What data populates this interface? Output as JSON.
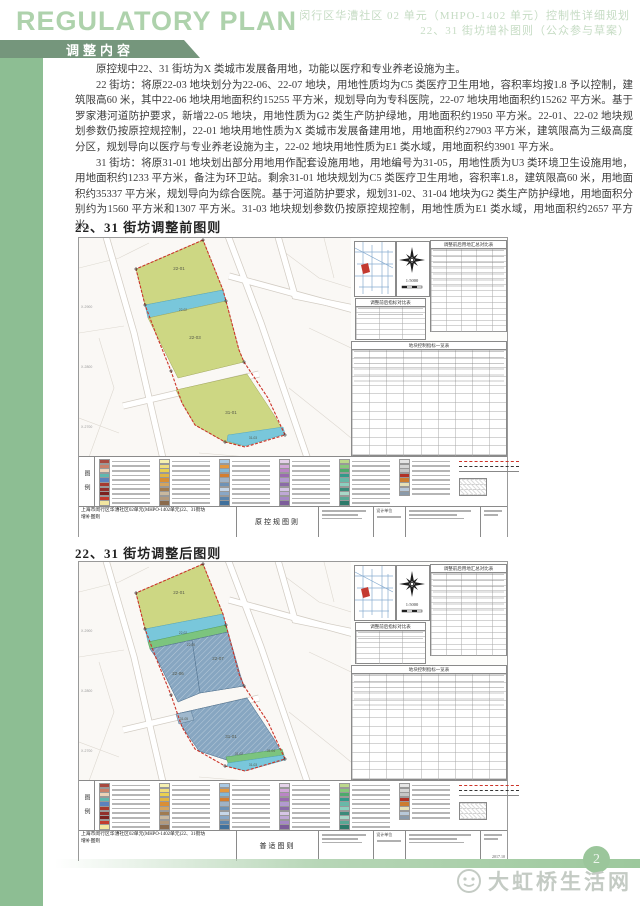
{
  "header": {
    "logo": "REGULATORY PLAN",
    "doc_title_line1": "闵行区华漕社区 02 单元（MHPO-1402 单元）控制性详细规划",
    "doc_title_line2": "22、31 街坊增补图则（公众参与草案）",
    "section": "调整内容"
  },
  "body": {
    "paragraphs": [
      "原控规中22、31 街坊为X 类城市发展备用地，功能以医疗和专业养老设施为主。",
      "22 街坊：将原22-03 地块划分为22-06、22-07 地块，用地性质均为C5 类医疗卫生用地，容积率均按1.8 予以控制，建筑限高60 米，其中22-06 地块用地面积约15255 平方米，规划导向为专科医院，22-07 地块用地面积约15262 平方米。基于罗家港河道防护要求，新增22-05 地块，用地性质为G2 类生产防护绿地，用地面积约1950 平方米。22-01、22-02 地块规划参数仍按原控规控制，22-01 地块用地性质为X 类城市发展备建用地，用地面积约27903 平方米，建筑限高为三级高度分区，规划导向以医疗与专业养老设施为主，22-02 地块用地性质为E1 类水域，用地面积约3901 平方米。",
      "31 街坊：将原31-01 地块划出部分用地用作配套设施用地，用地编号为31-05，用地性质为U3 类环境卫生设施用地，用地面积约1233 平方米，备注为环卫站。剩余31-01 地块规划为C5 类医疗卫生用地，容积率1.8，建筑限高60 米，用地面积约35337 平方米，规划导向为综合医院。基于河道防护要求，规划31-02、31-04 地块为G2 类生产防护绿地，用地面积分别约为1560 平方米和1307 平方米。31-03 地块规划参数仍按原控规控制，用地性质为E1 类水域，用地面积约2657 平方米。"
    ]
  },
  "coords": [
    "X-2900",
    "X-2800",
    "X-2700"
  ],
  "map_before": {
    "heading": "22、31 街坊调整前图则",
    "scale": "1:5000",
    "labels": {
      "a": "22-01",
      "b": "22-02",
      "c": "22-03",
      "d": "31-01",
      "e": "31-03"
    },
    "tables": {
      "summary_title": "调整前后用地汇总对比表",
      "indicator_title": "调整前后指标对比表",
      "parcel_title": "地块控制指标一览表"
    },
    "legend_label": "图例",
    "titleblock": {
      "title_l1": "上海市闵行区华漕社区02单元(MHPO-1402单元)22、31街坊",
      "title_l2": "增补图则",
      "sheet_type": "原控规图则",
      "design_label": "设计单位",
      "date": ""
    }
  },
  "map_after": {
    "heading": "22、31 街坊调整后图则",
    "scale": "1:5000",
    "labels": {
      "a": "22-01",
      "b": "22-02",
      "g": "22-05",
      "h": "22-06",
      "i": "22-07",
      "d": "31-01",
      "j": "31-05",
      "k": "31-02",
      "l": "31-04",
      "e": "31-03"
    },
    "tables": {
      "summary_title": "调整前后用地汇总对比表",
      "indicator_title": "调整前后指标对比表",
      "parcel_title": "地块控制指标一览表"
    },
    "legend_label": "图例",
    "titleblock": {
      "title_l1": "上海市闵行区华漕社区02单元(MHPO-1402单元)22、31街坊",
      "title_l2": "增补图则",
      "sheet_type": "普适图则",
      "design_label": "设计单位",
      "date": "2017.10"
    }
  },
  "legend": {
    "columns": [
      [
        "#a8493f",
        "#c9806a",
        "#ecd2b8",
        "#5fb8b0",
        "#5b82be",
        "#a73a2f",
        "#93302b",
        "#7c221f",
        "#c23b2e",
        "#f2e6a0"
      ],
      [
        "#f6f0b0",
        "#f0dd7c",
        "#ead04e",
        "#e2b542",
        "#d98f35",
        "#d4a45e",
        "#a07b50",
        "#c9b89e",
        "#b2997c",
        "#8a6a4c"
      ],
      [
        "#a9c9e4",
        "#e3993f",
        "#82b9d8",
        "#d47e31",
        "#9fb2c6",
        "#6e92b6",
        "#c6d6e8",
        "#89a7c6",
        "#5c85ac",
        "#40709c"
      ],
      [
        "#e5d2ea",
        "#d2a8da",
        "#bb85c6",
        "#9a6ab0",
        "#b29ad0",
        "#8a6ba8",
        "#d6c6e6",
        "#bfa8d6",
        "#a688c6",
        "#7c5c9a"
      ],
      [
        "#bcd88c",
        "#86c87a",
        "#4caa6c",
        "#329a8a",
        "#68b8a8",
        "#8cd0c0",
        "#3c8a7a",
        "#a8d8c8",
        "#58a895",
        "#2c7a6a"
      ],
      [
        "#e6e6e6",
        "#d6d6d6",
        "#c6c6c6",
        "#b23226",
        "#cc7c30",
        "#e6e0b6",
        "#b8c8d8",
        "#8a9aaa"
      ]
    ]
  },
  "footer": {
    "page_number": "2",
    "watermark": "大虹桥生活网"
  },
  "colors": {
    "side_band": "#8dbe93",
    "banner": "#75967c",
    "logo_green": "#aed2ac",
    "parcel_yellow": "#cdd783",
    "water_blue": "#79c7db",
    "buffer_green": "#7cc47e",
    "parcel_bluegray": "#87a6c1",
    "boundary_red": "#cc3328",
    "footer_green": "#9bc69b"
  }
}
